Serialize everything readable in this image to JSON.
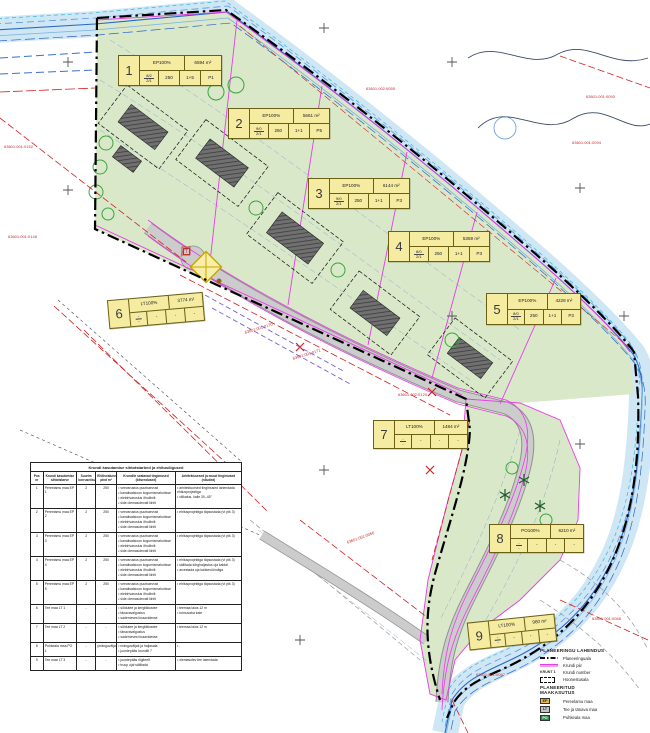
{
  "colors": {
    "plan_area_green": "#d8e8c9",
    "water_fill": "#cfe6f5",
    "water_line": "#2b67c9",
    "road_gray": "#cccccc",
    "plot_line_pink": "#e83ce8",
    "restriction_red": "#d42020",
    "label_box_yellow": "#f5eca2",
    "boundary_black": "#000000"
  },
  "map": {
    "transformer": "T",
    "plot_boxes": [
      {
        "num": "1",
        "use": "EP100%",
        "area": "6594 m²",
        "frac_top": "8/2",
        "frac_bot": "2/1",
        "cells": [
          "250",
          "1+5",
          "P1"
        ],
        "pos": {
          "left": 118,
          "top": 55,
          "w": 104,
          "h": 31,
          "rot": 0
        }
      },
      {
        "num": "2",
        "use": "EP100%",
        "area": "5661 m²",
        "frac_top": "9/0",
        "frac_bot": "2/1",
        "cells": [
          "250",
          "1+1",
          "P5"
        ],
        "pos": {
          "left": 228,
          "top": 108,
          "w": 102,
          "h": 31,
          "rot": 0
        }
      },
      {
        "num": "3",
        "use": "EP100%",
        "area": "6144 m²",
        "frac_top": "9/0",
        "frac_bot": "2/1",
        "cells": [
          "250",
          "1+1",
          "P3"
        ],
        "pos": {
          "left": 308,
          "top": 178,
          "w": 102,
          "h": 31,
          "rot": 0
        }
      },
      {
        "num": "4",
        "use": "EP100%",
        "area": "5359 m²",
        "frac_top": "8/0",
        "frac_bot": "2/1",
        "cells": [
          "250",
          "1+1",
          "P3"
        ],
        "pos": {
          "left": 388,
          "top": 231,
          "w": 102,
          "h": 31,
          "rot": 0
        }
      },
      {
        "num": "5",
        "use": "EP100%",
        "area": "4228 m²",
        "frac_top": "8/0",
        "frac_bot": "2/1",
        "cells": [
          "250",
          "1+1",
          "P3"
        ],
        "pos": {
          "left": 486,
          "top": 293,
          "w": 95,
          "h": 32,
          "rot": 0
        }
      },
      {
        "num": "6",
        "use": "LT100%",
        "area": "3774 m²",
        "frac_top": "-",
        "frac_bot": "-",
        "cells": [
          "-",
          "-",
          "-"
        ],
        "pos": {
          "left": 108,
          "top": 296,
          "w": 96,
          "h": 29,
          "rot": -5
        }
      },
      {
        "num": "7",
        "use": "LT100%",
        "area": "1484 m²",
        "frac_top": "-",
        "frac_bot": "-",
        "cells": [
          "-",
          "-",
          "-"
        ],
        "pos": {
          "left": 373,
          "top": 420,
          "w": 95,
          "h": 29,
          "rot": 0
        }
      },
      {
        "num": "8",
        "use": "PO100%",
        "area": "6210 m²",
        "frac_top": "-",
        "frac_bot": "-",
        "cells": [
          "-",
          "-",
          "-"
        ],
        "pos": {
          "left": 489,
          "top": 524,
          "w": 95,
          "h": 29,
          "rot": 0
        }
      },
      {
        "num": "9",
        "use": "LT100%",
        "area": "960 m²",
        "frac_top": "-",
        "frac_bot": "-",
        "cells": [
          "-",
          "-",
          "-"
        ],
        "pos": {
          "left": 468,
          "top": 618,
          "w": 88,
          "h": 28,
          "rot": -6
        }
      }
    ],
    "red_labels": [
      {
        "text": "63601:001:0152",
        "x": 4,
        "y": 144,
        "rot": 0
      },
      {
        "text": "63601:001:0148",
        "x": 8,
        "y": 234,
        "rot": 0
      },
      {
        "text": "63601:001:0170",
        "x": 244,
        "y": 330,
        "rot": -17
      },
      {
        "text": "63601:001:0171",
        "x": 292,
        "y": 356,
        "rot": -17
      },
      {
        "text": "63601:002:0055",
        "x": 366,
        "y": 86,
        "rot": 0
      },
      {
        "text": "63601:001:0093",
        "x": 586,
        "y": 94,
        "rot": 0
      },
      {
        "text": "63601:001:0094",
        "x": 572,
        "y": 140,
        "rot": 0
      },
      {
        "text": "63601:002:0120",
        "x": 398,
        "y": 392,
        "rot": 0
      },
      {
        "text": "63601:001:0066",
        "x": 346,
        "y": 540,
        "rot": -20
      },
      {
        "text": "63601:001:0067",
        "x": 476,
        "y": 672,
        "rot": 0
      },
      {
        "text": "63601:001:0068",
        "x": 592,
        "y": 616,
        "rot": 0
      }
    ]
  },
  "table": {
    "title": "Krundi kasutamise sihtotstarbed ja ehitusõigused",
    "headers": [
      "Pos nr",
      "Krundi kasutamise sihtotstarve",
      "Suurim korruselisus",
      "Ehitisealune pind m²",
      "Krundile seatavad tingimused (kitsendused)",
      "Arhitektuursed ja muud tingimused (nõuded)"
    ],
    "rows": [
      {
        "pos": "1",
        "name": "Pereelamu maa EP 1",
        "floors": "2",
        "footprint": "250",
        "conditions": [
          "veevarustus puurkaevust",
          "kanalisatsioon kogumismahutisse",
          "elektrivarustus õhuliinilt",
          "side olemasolevalt liinilt"
        ],
        "requirements": [
          "arhitektuursed tingimused lahendada ehitusprojektiga",
          "viilkatus, kalle 30–45°"
        ]
      },
      {
        "pos": "2",
        "name": "Pereelamu maa EP 2",
        "floors": "2",
        "footprint": "250",
        "conditions": [
          "veevarustus puurkaevust",
          "kanalisatsioon kogumismahutisse",
          "elektrivarustus õhuliinilt",
          "side olemasolevalt liinilt"
        ],
        "requirements": [
          "ehitusprojektiga täpsustada (vt ptk 3)"
        ]
      },
      {
        "pos": "3",
        "name": "Pereelamu maa EP 3",
        "floors": "2",
        "footprint": "250",
        "conditions": [
          "veevarustus puurkaevust",
          "kanalisatsioon kogumismahutisse",
          "elektrivarustus õhuliinilt",
          "side olemasolevalt liinilt"
        ],
        "requirements": [
          "ehitusprojektiga täpsustada (vt ptk 3)"
        ]
      },
      {
        "pos": "4",
        "name": "Pereelamu maa EP 4",
        "floors": "2",
        "footprint": "250",
        "conditions": [
          "veevarustus puurkaevust",
          "kanalisatsioon kogumismahutisse",
          "elektrivarustus õhuliinilt",
          "side olemasolevalt liinilt"
        ],
        "requirements": [
          "ehitusprojektiga täpsustada (vt ptk 3)",
          "säilitada kõrghaljastus oja kaldal",
          "arvestada oja kaitsevööndiga"
        ]
      },
      {
        "pos": "5",
        "name": "Pereelamu maa EP 5",
        "floors": "2",
        "footprint": "250",
        "conditions": [
          "veevarustus puurkaevust",
          "kanalisatsioon kogumismahutisse",
          "elektrivarustus õhuliinilt",
          "side olemasolevalt liinilt"
        ],
        "requirements": [
          "ehitusprojektiga täpsustada (vt ptk 3)"
        ]
      },
      {
        "pos": "6",
        "name": "Tee maa LT 1",
        "floors": "-",
        "footprint": "-",
        "conditions": [
          "sõidutee ja kergliiklustee",
          "tänavavalgustus",
          "sademevesi kraavidesse"
        ],
        "requirements": [
          "teemaa laius 12 m",
          "tolmuvaba kate"
        ]
      },
      {
        "pos": "7",
        "name": "Tee maa LT 2",
        "floors": "-",
        "footprint": "-",
        "conditions": [
          "sõidutee ja kergliiklustee",
          "tänavavalgustus",
          "sademevesi kraavidesse"
        ],
        "requirements": [
          "teemaa laius 12 m"
        ]
      },
      {
        "pos": "8",
        "name": "Puhkeala maa PO 1",
        "floors": "-",
        "footprint": "(mänguväljak)",
        "conditions": [
          "mänguväljak ja haljasala",
          "juurdepääs krundilt 7"
        ],
        "requirements": [
          "-"
        ]
      },
      {
        "pos": "9",
        "name": "Tee maa LT 3",
        "floors": "-",
        "footprint": "-",
        "conditions": [
          "juurdepääs riigiteelt",
          "truup ojal säilitada"
        ],
        "requirements": [
          "olemasolev tee laiendada"
        ]
      }
    ]
  },
  "legend": {
    "title1": "PLANEERINGU LAHENDUS",
    "items1": [
      {
        "sym": "planning-area",
        "label": "Planeeringuala"
      },
      {
        "sym": "plot-boundary",
        "label": "Krundi piir"
      },
      {
        "sym": "plot-number",
        "symtext": "KRUNT 1",
        "label": "Krundi number"
      },
      {
        "sym": "building-area",
        "label": "Hoonestusala"
      }
    ],
    "title2": "PLANEERITUD MAAKASUTUS",
    "items2": [
      {
        "code": "EP",
        "color": "#e9b94d",
        "text_color": "#222",
        "label": "Pereelamu maa"
      },
      {
        "code": "LT",
        "color": "#c4c4c4",
        "text_color": "#222",
        "label": "Tee ja tänava maa"
      },
      {
        "code": "PO",
        "color": "#2f8f4f",
        "text_color": "#fff",
        "label": "Puhkeala maa"
      }
    ]
  }
}
